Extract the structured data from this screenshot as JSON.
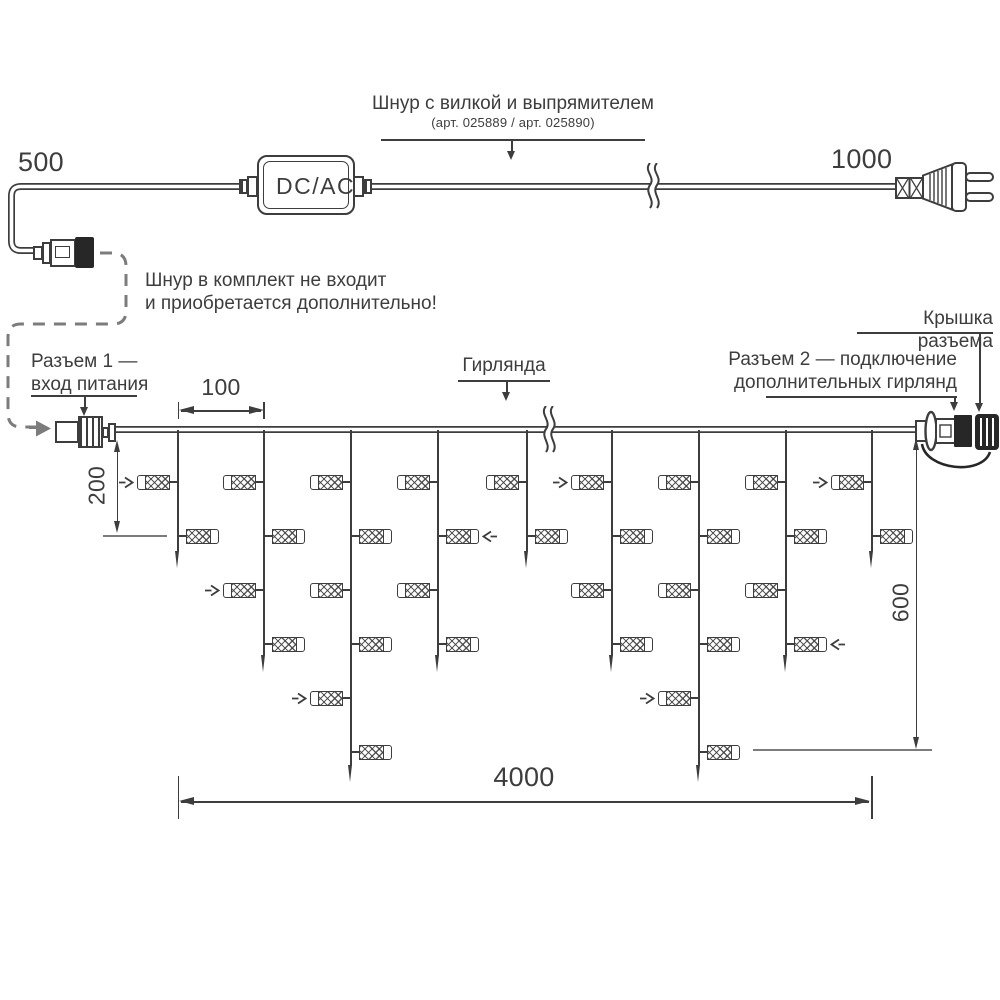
{
  "colors": {
    "line": "#3d3d3d",
    "gray": "#7c7c7c",
    "black_part": "#272727"
  },
  "power_cord": {
    "label": "Шнур с вилкой и выпрямителем",
    "sublabel": "(арт. 025889 /  арт. 025890)",
    "length_left": "500",
    "length_right": "1000",
    "adapter_label": "DC/AC",
    "note_line1": "Шнур в комплект не входит",
    "note_line2": "и приобретается дополнительно!"
  },
  "labels": {
    "connector1_line1": "Разъем 1 —",
    "connector1_line2": "вход питания",
    "garland": "Гирлянда",
    "connector2_line1": "Разъем 2 — подключение",
    "connector2_line2": "дополнительных гирлянд",
    "cap": "Крышка разъема"
  },
  "dimensions": {
    "drop_spacing": "100",
    "first_drop_length": "200",
    "curtain_height": "600",
    "curtain_width": "4000"
  },
  "garland": {
    "rows_start_y": 482,
    "row_step": 54,
    "tip_y": {
      "short": 568,
      "medium": 672,
      "long": 782
    },
    "drops": [
      {
        "x": 178,
        "length": "short",
        "bulbs": [
          {
            "row": 1,
            "side": "L",
            "arrow": true
          },
          {
            "row": 2,
            "side": "R"
          }
        ]
      },
      {
        "x": 264,
        "length": "medium",
        "bulbs": [
          {
            "row": 1,
            "side": "L"
          },
          {
            "row": 2,
            "side": "R"
          },
          {
            "row": 3,
            "side": "L",
            "arrow": true
          },
          {
            "row": 4,
            "side": "R"
          }
        ]
      },
      {
        "x": 351,
        "length": "long",
        "bulbs": [
          {
            "row": 1,
            "side": "L"
          },
          {
            "row": 2,
            "side": "R"
          },
          {
            "row": 3,
            "side": "L"
          },
          {
            "row": 4,
            "side": "R"
          },
          {
            "row": 5,
            "side": "L",
            "arrow": true
          },
          {
            "row": 6,
            "side": "R"
          }
        ]
      },
      {
        "x": 438,
        "length": "medium",
        "bulbs": [
          {
            "row": 1,
            "side": "L"
          },
          {
            "row": 2,
            "side": "R",
            "arrow": true
          },
          {
            "row": 3,
            "side": "L"
          },
          {
            "row": 4,
            "side": "R"
          }
        ]
      },
      {
        "x": 527,
        "length": "short",
        "bulbs": [
          {
            "row": 1,
            "side": "L"
          },
          {
            "row": 2,
            "side": "R"
          }
        ]
      },
      {
        "x": 612,
        "length": "medium",
        "bulbs": [
          {
            "row": 1,
            "side": "L",
            "arrow": true
          },
          {
            "row": 2,
            "side": "R"
          },
          {
            "row": 3,
            "side": "L"
          },
          {
            "row": 4,
            "side": "R"
          }
        ]
      },
      {
        "x": 699,
        "length": "long",
        "bulbs": [
          {
            "row": 1,
            "side": "L"
          },
          {
            "row": 2,
            "side": "R"
          },
          {
            "row": 3,
            "side": "L"
          },
          {
            "row": 4,
            "side": "R"
          },
          {
            "row": 5,
            "side": "L",
            "arrow": true
          },
          {
            "row": 6,
            "side": "R"
          }
        ]
      },
      {
        "x": 786,
        "length": "medium",
        "bulbs": [
          {
            "row": 1,
            "side": "L"
          },
          {
            "row": 2,
            "side": "R"
          },
          {
            "row": 3,
            "side": "L"
          },
          {
            "row": 4,
            "side": "R",
            "arrow": true
          }
        ]
      },
      {
        "x": 872,
        "length": "short",
        "bulbs": [
          {
            "row": 1,
            "side": "L",
            "arrow": true
          },
          {
            "row": 2,
            "side": "R"
          }
        ]
      }
    ]
  }
}
